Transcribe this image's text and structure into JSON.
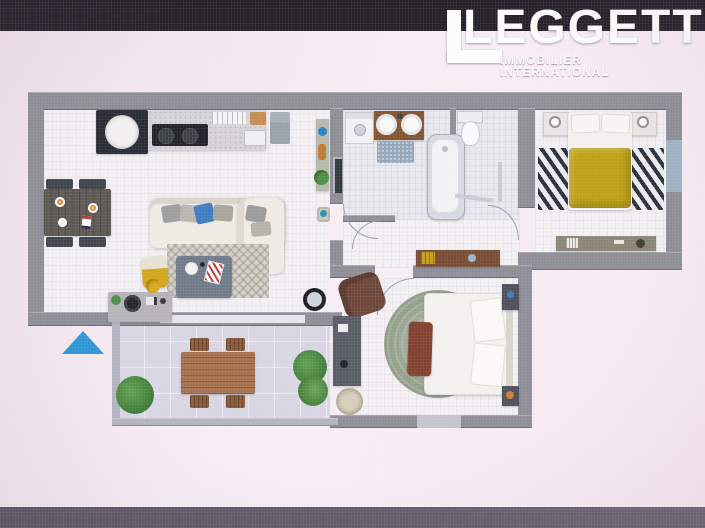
{
  "logo": {
    "mark": "L",
    "title": "LEGGETT",
    "subtitle": "IMMOBILIER INTERNATIONAL"
  },
  "colors": {
    "topBar": "#242028",
    "bottomBar": "#5a5462",
    "bgA": "#efe0e9",
    "bgB": "#f7eef4",
    "bgC": "#f8e9f1",
    "wall": "#8d8e96",
    "wallInner": "#9aa0a8",
    "wallLight": "#c3c5cf",
    "floor": "#f3f0f3",
    "bathFloor": "#eae8ef",
    "terrace": "#d9d6e4",
    "logoWhite": "#fdfdfd",
    "duvetYellow": "#bfa014",
    "accentBlue": "#3f7cc0",
    "northBlue": "#2d95d5",
    "plantGreen": "#4e8f45",
    "woodBrown": "#a5714e",
    "darkWood": "#774c34",
    "sofaCream": "#efebe4"
  },
  "plan": {
    "type": "apartment-floor-plan-3d-top-view",
    "rooms": [
      {
        "id": "kitchen-living",
        "furniture": [
          "kitchen counter with hob",
          "round appliance",
          "sink",
          "fridge",
          "shelf console with plant",
          "dining table with plates",
          "four dining chairs",
          "corner sofa with cushions",
          "coffee table on rug",
          "yellow pouf",
          "media sideboard with turntable",
          "round black mirror"
        ]
      },
      {
        "id": "bathroom",
        "furniture": [
          "washing machine",
          "double washbasin vanity",
          "blue bath mat",
          "bathtub",
          "toilet",
          "towel rails",
          "tall mirror"
        ]
      },
      {
        "id": "hallway",
        "furniture": [
          "wooden sideboard with books"
        ]
      },
      {
        "id": "bedroom-1",
        "furniture": [
          "double bed with yellow duvet",
          "two nightstands with lamps",
          "black and white striped rug",
          "long dresser",
          "window"
        ]
      },
      {
        "id": "bedroom-2",
        "furniture": [
          "double bed white",
          "round textured rug",
          "foot bench",
          "armchair",
          "desk",
          "two dark nightstands",
          "rattan pouf"
        ]
      },
      {
        "id": "terrace",
        "furniture": [
          "outdoor dining table",
          "four outdoor chairs",
          "three plants"
        ]
      }
    ],
    "annotations": [
      "blue triangle marker"
    ]
  }
}
